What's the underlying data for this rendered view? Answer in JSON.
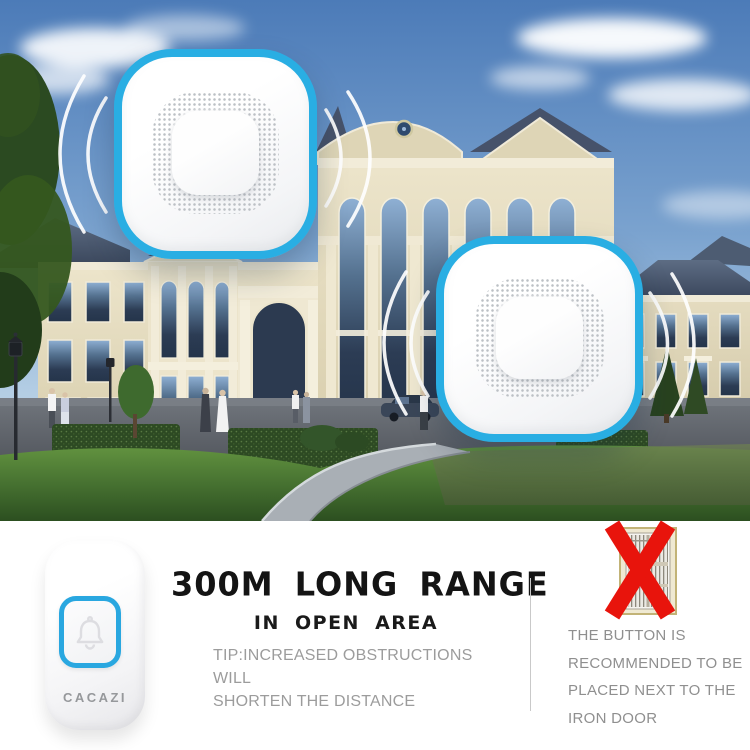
{
  "brand": "CACAZI",
  "colors": {
    "accent_blue": "#29aee3",
    "alert_red": "#e8140c",
    "title_black": "#141414",
    "tip_gray": "#9c9c9c",
    "warning_gray": "#8f8f8f",
    "divider_gray": "#c9c9c9"
  },
  "range_section": {
    "title": "300M LONG RANGE",
    "subtitle": "IN OPEN AREA",
    "tip_lines": [
      "TIP:INCREASED OBSTRUCTIONS WILL",
      "SHORTEN THE DISTANCE"
    ]
  },
  "warning_section": {
    "lines": [
      "THE BUTTON IS",
      "RECOMMENDED TO BE",
      "PLACED NEXT TO THE",
      "IRON DOOR"
    ]
  },
  "transmitter": {
    "brand_label": "CACAZI"
  }
}
